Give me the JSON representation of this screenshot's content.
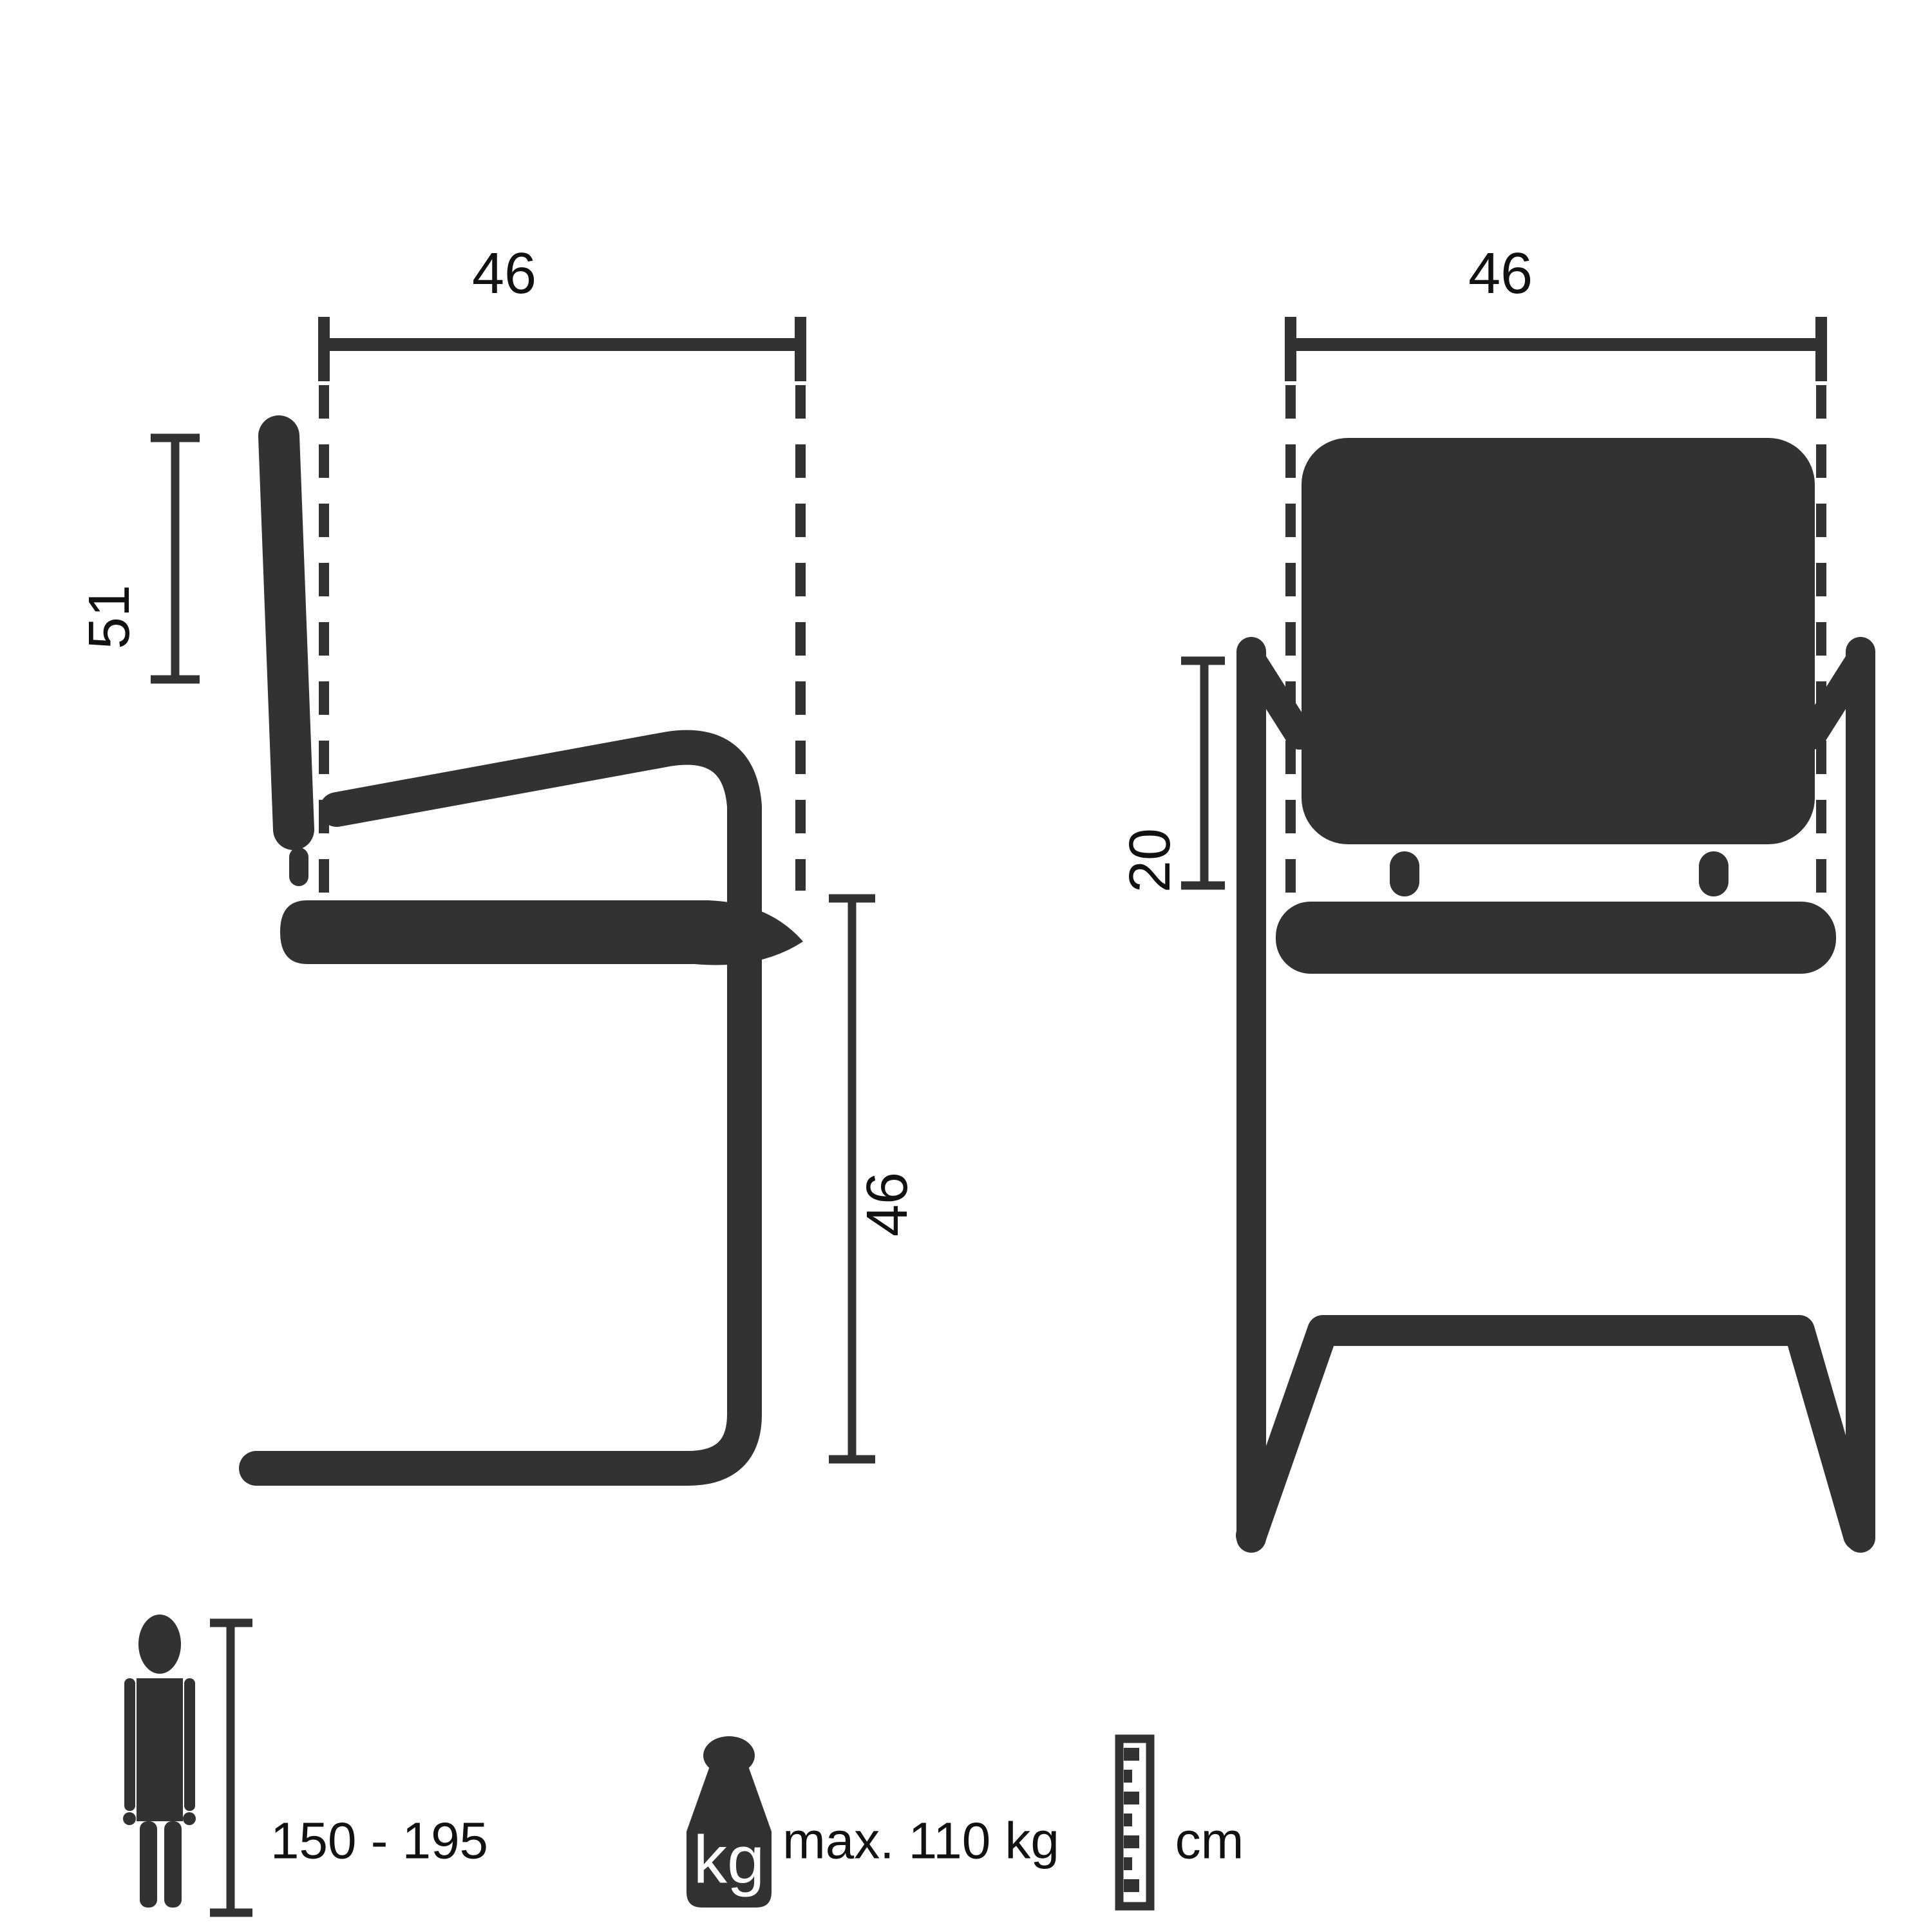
{
  "colors": {
    "ink": "#323232",
    "bg": "#ffffff",
    "label": "#111111"
  },
  "side_view": {
    "name": "chair side view",
    "seat_width_label": "46",
    "backrest_height_label": "51",
    "seat_height_label": "46"
  },
  "front_view": {
    "name": "chair front view",
    "seat_width_label": "46",
    "armrest_to_seat_label": "20"
  },
  "legend": {
    "person_height_range": "150 - 195",
    "weight_icon_text": "kg",
    "max_weight": "max. 110 kg",
    "unit": "cm"
  }
}
